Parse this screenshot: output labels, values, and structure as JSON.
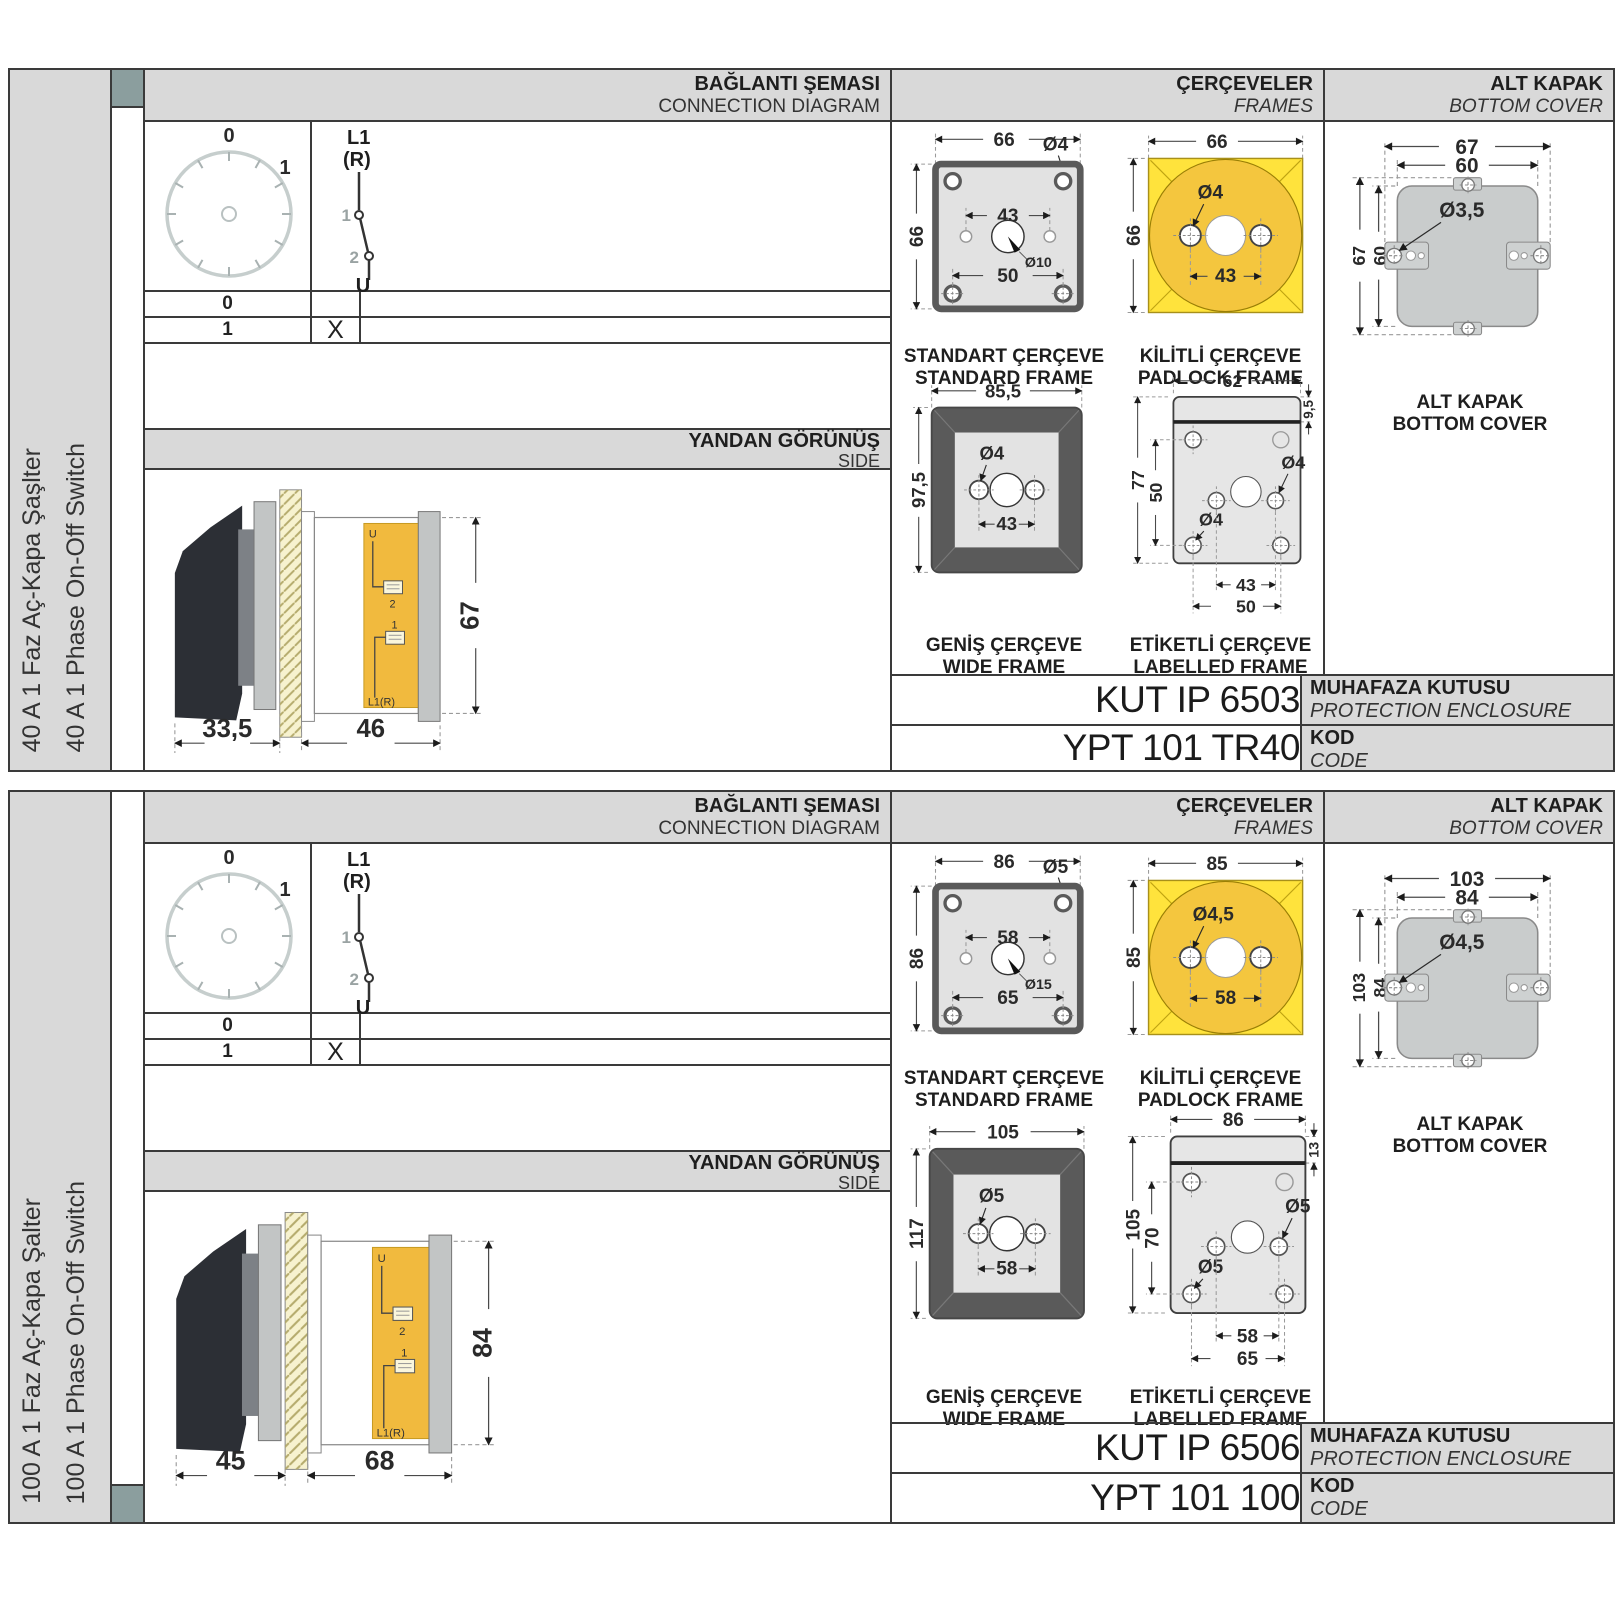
{
  "shared": {
    "headers": {
      "conn_tr": "BAĞLANTI ŞEMASI",
      "conn_en": "CONNECTION DIAGRAM",
      "frames_tr": "ÇERÇEVELER",
      "frames_en": "FRAMES",
      "cover_tr": "ALT KAPAK",
      "cover_en": "BOTTOM COVER"
    },
    "side_header": {
      "tr": "YANDAN GÖRÜNÜŞ",
      "en": "SIDE"
    },
    "diagram": {
      "pos0": "0",
      "pos1": "1",
      "l1": "L1",
      "r": "(R)",
      "c1": "1",
      "c2": "2",
      "u": "U"
    },
    "table": {
      "row0": "0",
      "row1": "1",
      "mark0": "",
      "mark1": "X"
    },
    "sideview_labels": {
      "u": "U",
      "t2": "2",
      "t1": "1",
      "l1r": "L1(R)"
    },
    "captions": {
      "standard_tr": "STANDART ÇERÇEVE",
      "standard_en": "STANDARD FRAME",
      "padlock_tr": "KİLİTLİ ÇERÇEVE",
      "padlock_en": "PADLOCK FRAME",
      "wide_tr": "GENİŞ ÇERÇEVE",
      "wide_en": "WIDE FRAME",
      "labelled_tr": "ETİKETLİ ÇERÇEVE",
      "labelled_en": "LABELLED FRAME",
      "cover_tr": "ALT KAPAK",
      "cover_en": "BOTTOM COVER"
    },
    "code_labels": {
      "enclosure_tr": "MUHAFAZA KUTUSU",
      "enclosure_en": "PROTECTION ENCLOSURE",
      "kod_tr": "KOD",
      "kod_en": "CODE"
    }
  },
  "panels": [
    {
      "name_tr": "40 A 1 Faz Aç-Kapa Şaşlter",
      "name_en": "40 A 1 Phase On-Off Switch",
      "sideview": {
        "front": "33,5",
        "body": "46",
        "height": "67"
      },
      "standard": {
        "w": "66",
        "h": "66",
        "hole": "Ø4",
        "span": "43",
        "center": "Ø10",
        "bottom": "50"
      },
      "padlock": {
        "w": "66",
        "h": "66",
        "hole": "Ø4",
        "span": "43"
      },
      "wide": {
        "w": "85,5",
        "h": "97,5",
        "hole": "Ø4",
        "span": "43"
      },
      "labelled": {
        "w": "62",
        "strip": "9,5",
        "h": "77",
        "inner": "50",
        "hole": "Ø4",
        "hole2": "Ø4",
        "span": "43",
        "span2": "50"
      },
      "cover": {
        "w": "67",
        "w2": "60",
        "h": "67",
        "h2": "60",
        "hole": "Ø3,5"
      },
      "codes": {
        "enclosure": "KUT IP 6503",
        "code": "YPT 101 TR40"
      }
    },
    {
      "name_tr": "100 A 1 Faz Aç-Kapa Şalter",
      "name_en": "100 A 1 Phase On-Off Switch",
      "sideview": {
        "front": "45",
        "body": "68",
        "height": "84"
      },
      "standard": {
        "w": "86",
        "h": "86",
        "hole": "Ø5",
        "span": "58",
        "center": "Ø15",
        "bottom": "65"
      },
      "padlock": {
        "w": "85",
        "h": "85",
        "hole": "Ø4,5",
        "span": "58"
      },
      "wide": {
        "w": "105",
        "h": "117",
        "hole": "Ø5",
        "span": "58"
      },
      "labelled": {
        "w": "86",
        "strip": "13",
        "h": "105",
        "inner": "70",
        "hole": "Ø5",
        "hole2": "Ø5",
        "span": "58",
        "span2": "65"
      },
      "cover": {
        "w": "103",
        "w2": "84",
        "h": "103",
        "h2": "84",
        "hole": "Ø4,5"
      },
      "codes": {
        "enclosure": "KUT IP 6506",
        "code": "YPT 101 100"
      }
    }
  ]
}
